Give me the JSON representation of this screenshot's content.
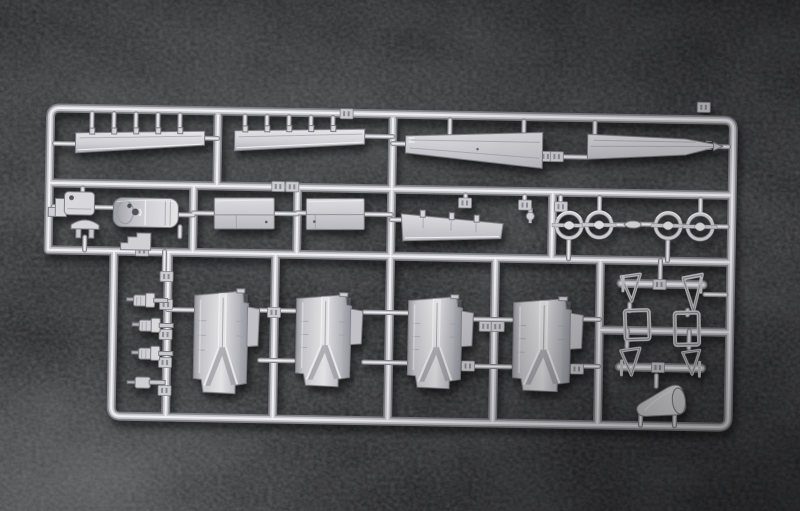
{
  "scene": {
    "type": "photograph",
    "subject": "injection-molded plastic model kit sprue (parts runner) with unpainted aircraft parts",
    "surface": "black grained leather background",
    "visible_text": "none (part-number tags are illegible embossed plates)"
  },
  "colors": {
    "background_leather": "#17171a",
    "leather_highlight": "#96989b",
    "plastic_base": "#cfcfd4",
    "plastic_highlight": "#f0f0f3",
    "plastic_shadow": "#7d7d84"
  },
  "sprue": {
    "frame": "rounded rectangular runner frame, tilted about 1 degree, with internal horizontal and vertical runners",
    "rows": [
      {
        "name": "top-row",
        "parts": [
          "flap-blade-left",
          "flap-blade-right",
          "wing-panel-left",
          "wing-panel-right"
        ]
      },
      {
        "name": "middle-row",
        "parts": [
          "corner-bracket",
          "hinged-plate",
          "cowl-shell-cylinder",
          "dome-cap",
          "step-bracket",
          "door-panel-1",
          "door-panel-2",
          "aileron-flap",
          "detail-knob",
          "hoop-ring-1",
          "hoop-ring-2",
          "spinner-bullet",
          "hoop-ring-3",
          "hoop-ring-4"
        ]
      },
      {
        "name": "bottom-row",
        "parts": [
          "exhaust-stub-1",
          "exhaust-stub-2",
          "exhaust-stub-3",
          "exhaust-stub-4",
          "nacelle-shell-1",
          "nacelle-shell-2",
          "nacelle-shell-3",
          "nacelle-shell-4",
          "gear-strut-triangle-1",
          "gear-strut-triangle-2",
          "gear-strut-triangle-3",
          "gear-strut-triangle-4",
          "gear-door-frame-1",
          "gear-door-frame-2",
          "axle-bracket-top",
          "axle-bracket-bottom",
          "intake-cone"
        ]
      }
    ],
    "part_counts": {
      "long_flap_blades": 2,
      "large_wing_panels": 2,
      "small_flap_panel": 1,
      "door_panels": 2,
      "hoop_rings": 4,
      "nacelle_shells": 4,
      "triangle_struts": 4,
      "door_frames": 2,
      "exhaust_stubs": 4,
      "number_tags": "many small rectangular tags"
    }
  }
}
